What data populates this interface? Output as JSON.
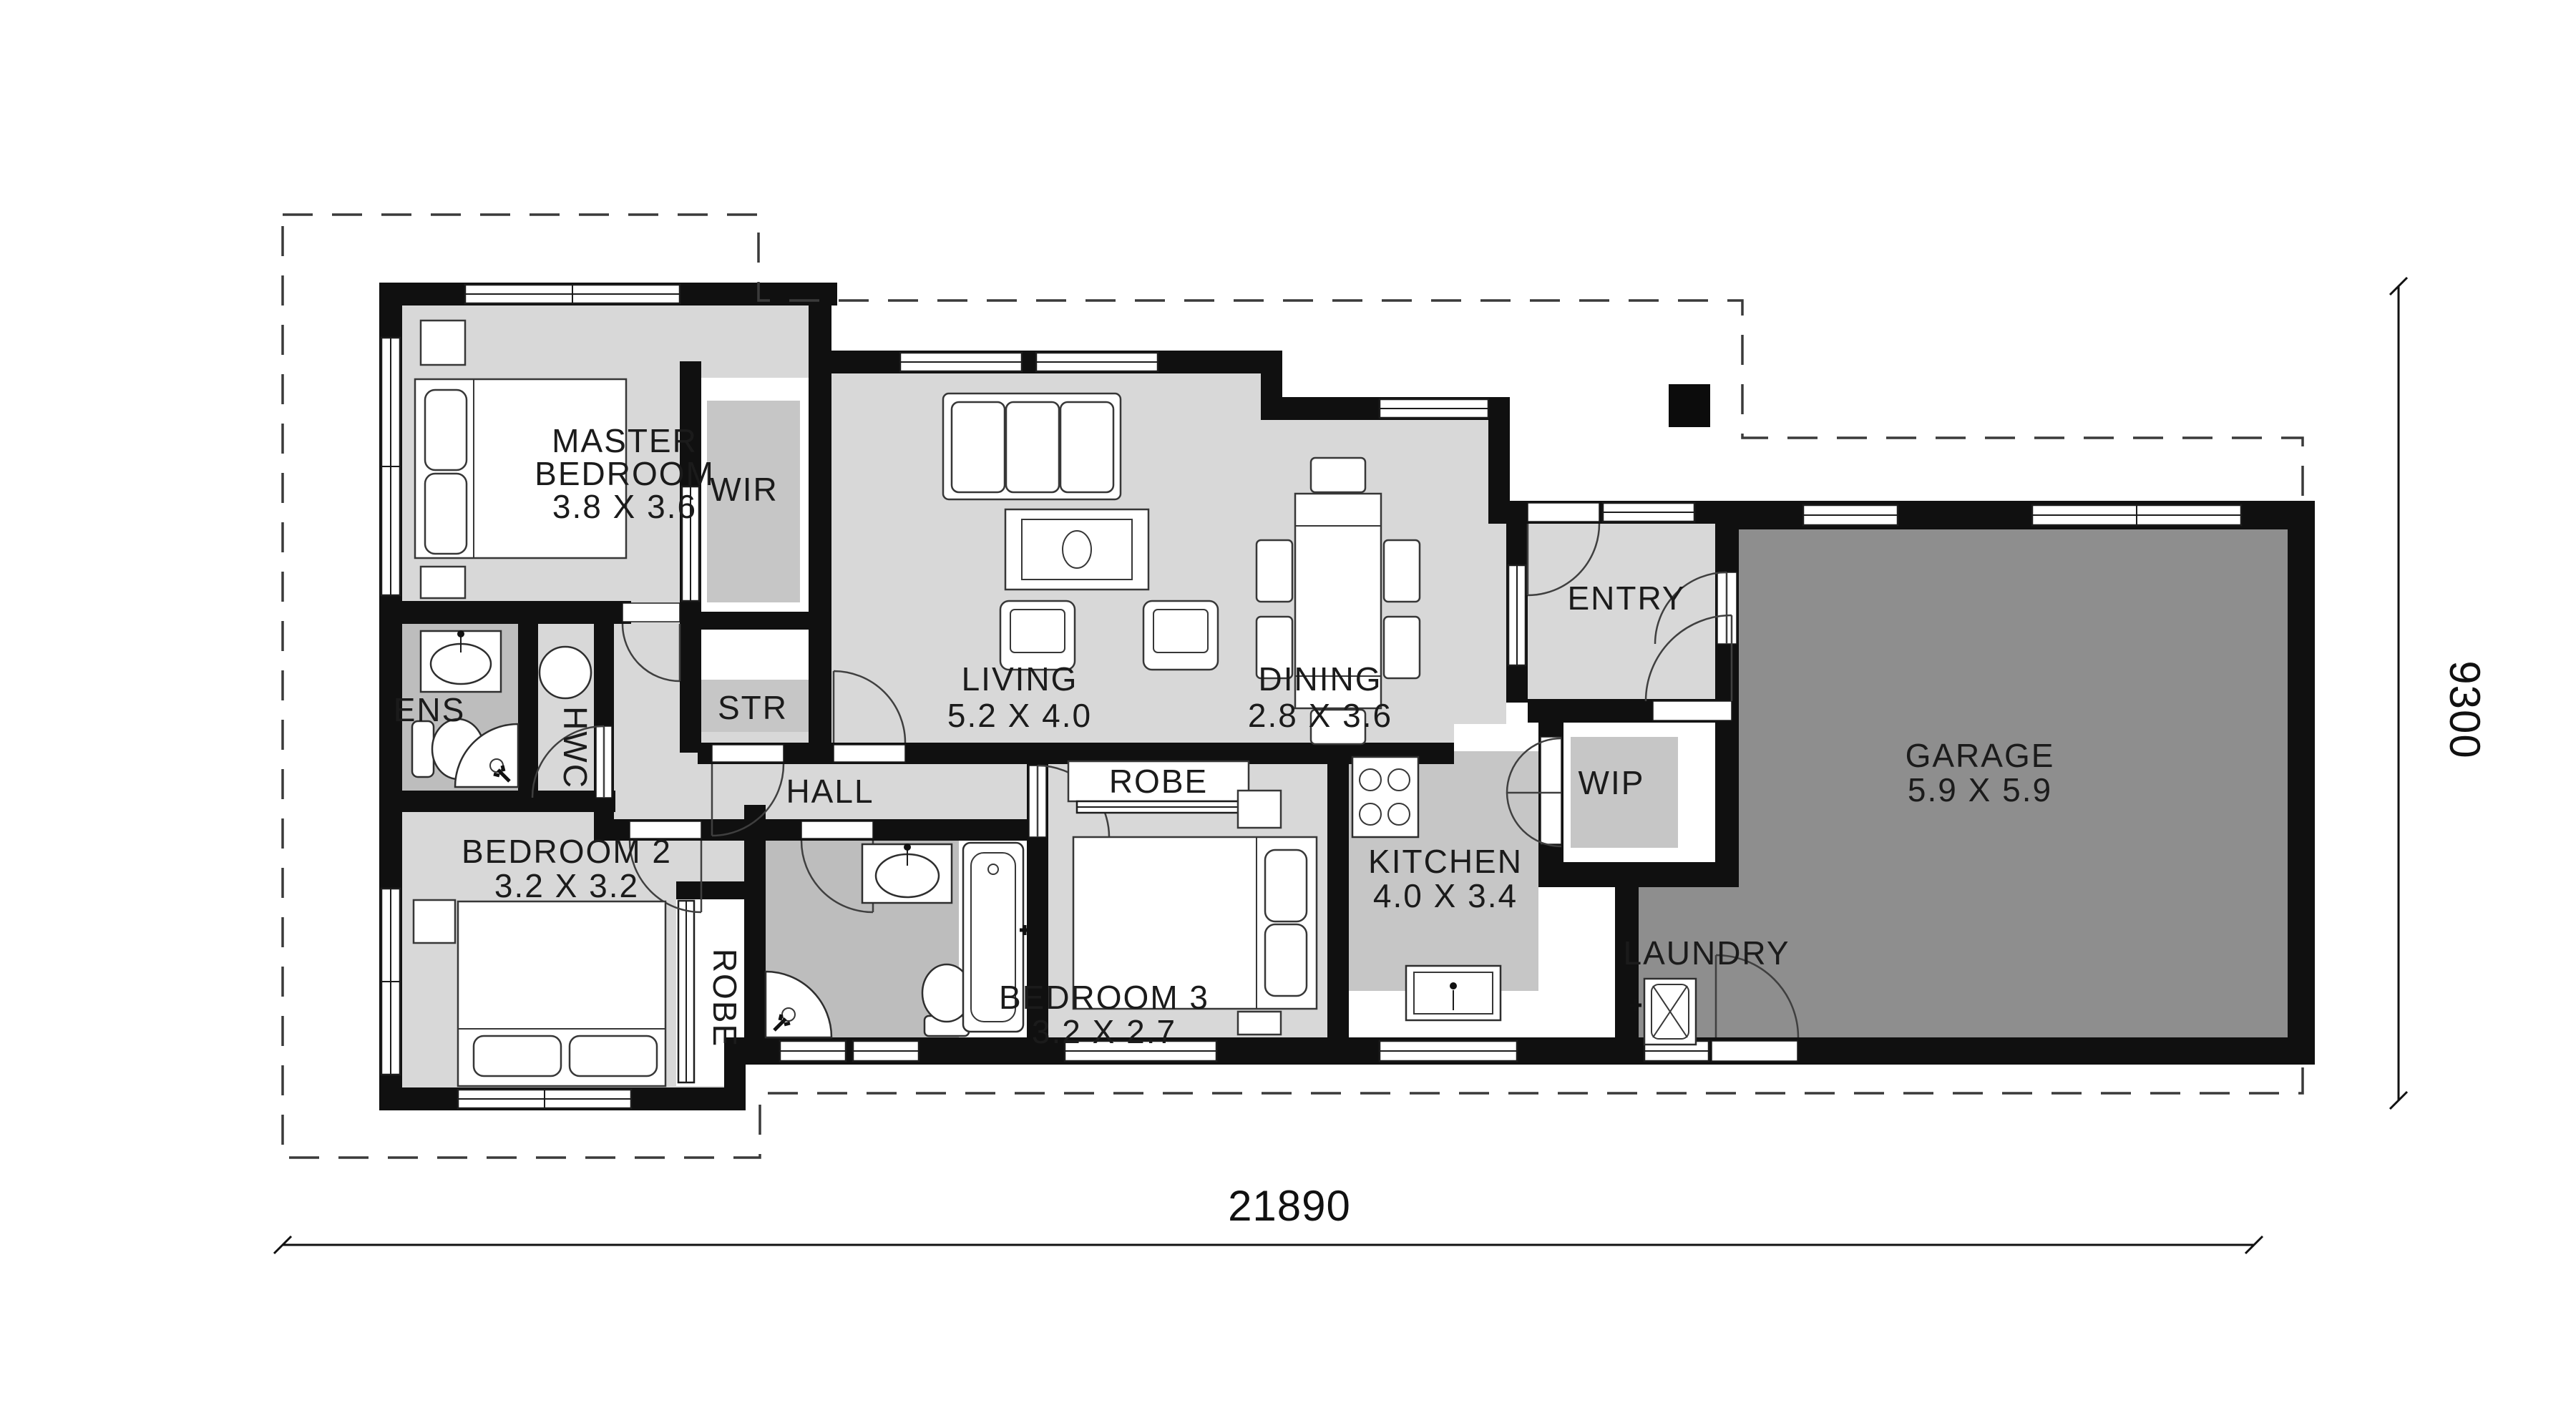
{
  "plan": {
    "type": "single-storey house floor plan",
    "colors": {
      "wall": "#101010",
      "floor_light": "#d8d8d8",
      "floor_mid": "#bdbdbd",
      "bench_gray": "#c6c6c6",
      "floor_dark": "#8e8e8e",
      "background": "#ffffff"
    },
    "dimensions": {
      "overall_width_label": "21890",
      "overall_height_label": "9300"
    },
    "rooms": {
      "master_bedroom": {
        "line1": "MASTER",
        "line2": "BEDROOM",
        "size": "3.8 X 3.6"
      },
      "wir": {
        "name": "WIR"
      },
      "str": {
        "name": "STR"
      },
      "ens": {
        "name": "ENS"
      },
      "hwc": {
        "name": "HWC"
      },
      "hall": {
        "name": "HALL"
      },
      "living": {
        "name": "LIVING",
        "size": "5.2 X 4.0"
      },
      "dining": {
        "name": "DINING",
        "size": "2.8 X 3.6"
      },
      "entry": {
        "name": "ENTRY"
      },
      "wip": {
        "name": "WIP"
      },
      "kitchen": {
        "name": "KITCHEN",
        "size": "4.0 X 3.4"
      },
      "laundry": {
        "name": "LAUNDRY"
      },
      "garage": {
        "name": "GARAGE",
        "size": "5.9 X 5.9"
      },
      "bedroom2": {
        "name": "BEDROOM 2",
        "size": "3.2 X 3.2"
      },
      "bedroom3": {
        "name": "BEDROOM 3",
        "size": "3.2 X 2.7"
      },
      "robe_bedroom2": {
        "name": "ROBE"
      },
      "robe_bedroom3": {
        "name": "ROBE"
      }
    }
  }
}
